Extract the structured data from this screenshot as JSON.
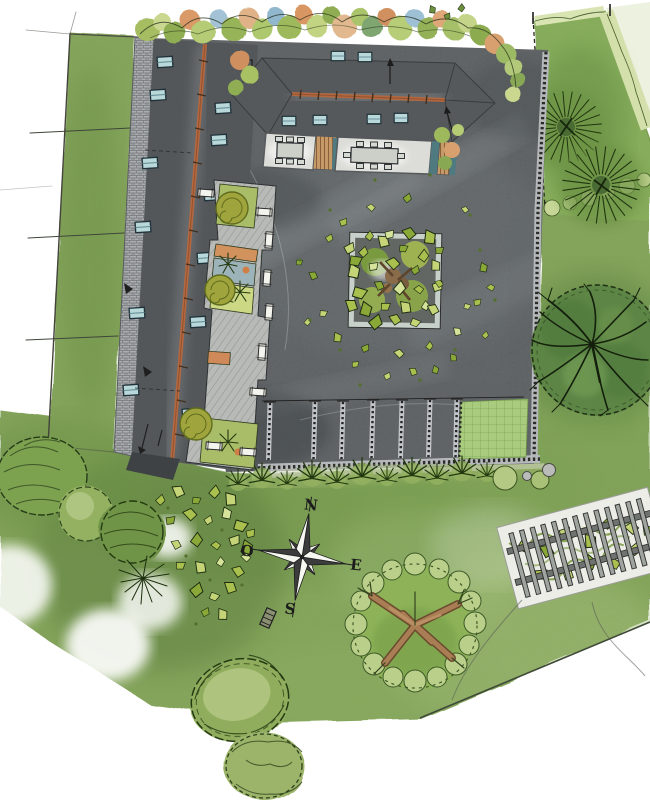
{
  "meta": {
    "title": "Hand-drawn landscape site plan, watercolor sketch, plan view",
    "type": "site-plan"
  },
  "compass": {
    "n": "N",
    "w": "O",
    "e": "E",
    "s": "S"
  },
  "palette": {
    "lawn": "#85a55b",
    "lawn_dark": "#6a8f45",
    "paving": "#5d6163",
    "roof": "#53575a",
    "ridge_orange": "#b5683f",
    "skylight_blue": "#b9d8da",
    "wall_stone": "#aaadaf",
    "terrace": "#dcddd8",
    "deck_wood": "#c59a68",
    "planter_teal": "#4e7a80",
    "canopy_light": "#b9cf8a",
    "canopy_dark": "#5d8544",
    "leaf_green": "#a9c04f",
    "trunk_brown": "#a97e55",
    "pergola_pad": "#ecede7",
    "compass_dark": "#3c3c3c",
    "compass_light": "#f7f7f2"
  },
  "features": [
    "lawn",
    "left-building-roof",
    "top-building-roof",
    "perimeter-wall",
    "courtyard",
    "walkway-planters",
    "central-tree-planter",
    "parking-bays",
    "grid-lawn-panel",
    "hedge-strip",
    "right-tree",
    "round-tree",
    "top-right-garden",
    "pergola",
    "compass-rose",
    "shrub-cluster",
    "top-planting-border"
  ]
}
